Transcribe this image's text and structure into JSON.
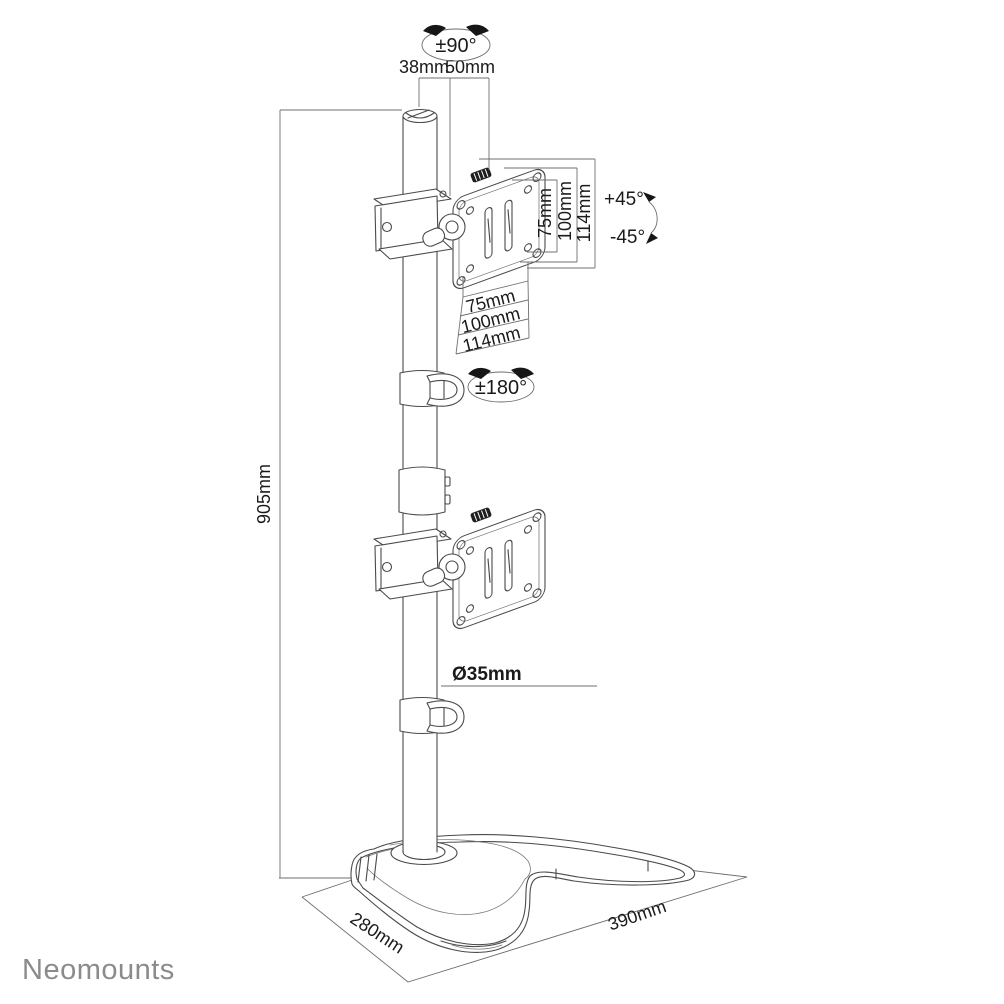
{
  "logo": {
    "text": "Neomounts",
    "color": "#8b8b8b"
  },
  "dims": {
    "rotation_pivot": "±90°",
    "pole_top_width": "38mm",
    "pole_top_depth": "50mm",
    "vesa_vertical": [
      "75mm",
      "100mm",
      "114mm"
    ],
    "tilt_up": "+45°",
    "tilt_down": "-45°",
    "vesa_horizontal": [
      "75mm",
      "100mm",
      "114mm"
    ],
    "rotation_vesa": "±180°",
    "pole_height": "905mm",
    "pole_diameter": "Ø35mm",
    "base_depth": "280mm",
    "base_width": "390mm"
  },
  "colors": {
    "background": "#ffffff",
    "line": "#4a4a4a",
    "dimension_line": "#6f6f6f",
    "text": "#1a1a1a",
    "logo": "#8b8b8b"
  }
}
